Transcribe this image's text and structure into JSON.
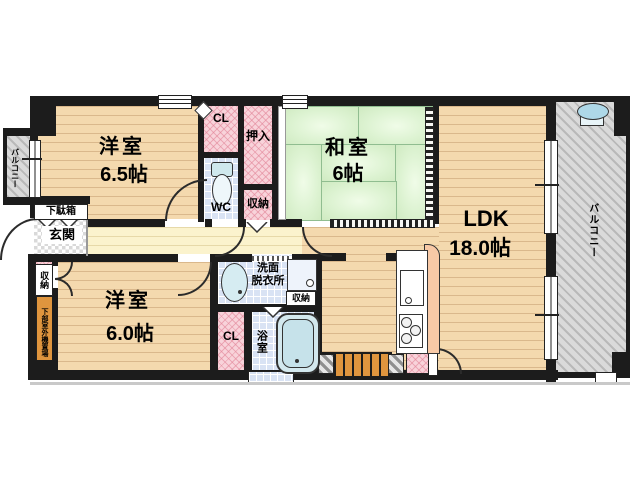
{
  "plan": {
    "type": "apartment-floor-plan",
    "rooms": {
      "western_room_1": {
        "name": "洋室",
        "size": "6.5帖"
      },
      "japanese_room": {
        "name": "和室",
        "size": "6帖"
      },
      "ldk": {
        "name": "LDK",
        "size": "18.0帖"
      },
      "western_room_2": {
        "name": "洋室",
        "size": "6.0帖"
      }
    },
    "labels": {
      "balcony_left": "バルコニー",
      "balcony_right": "バルコニー",
      "closet_top": "CL",
      "closet_bottom": "CL",
      "oshiire": "押入",
      "wc": "WC",
      "storage_hall": "収納",
      "storage_entry": "収納",
      "storage_washroom": "収納",
      "shoe_cabinet": "下駄箱",
      "entrance": "玄関",
      "washroom_line1": "洗面",
      "washroom_line2": "脱衣所",
      "bathroom": "浴室",
      "outdoor_unit": "下部室外機置場"
    },
    "fixtures": [
      "toilet",
      "bathtub",
      "wash-basin",
      "washing-machine",
      "kitchen-sink",
      "gas-stove",
      "balcony-slop-sink"
    ],
    "colors": {
      "wall": "#1c1c1c",
      "wood_floor": "#f4d9ae",
      "corridor": "#fbf3cd",
      "tatami": "#d9efca",
      "closet_pink": "#f8d3da",
      "wet_area_blue": "#d9e3f4",
      "balcony_gray": "#dadada",
      "accent_orange": "#df953e",
      "counter_peach": "#f8c9a6"
    }
  }
}
